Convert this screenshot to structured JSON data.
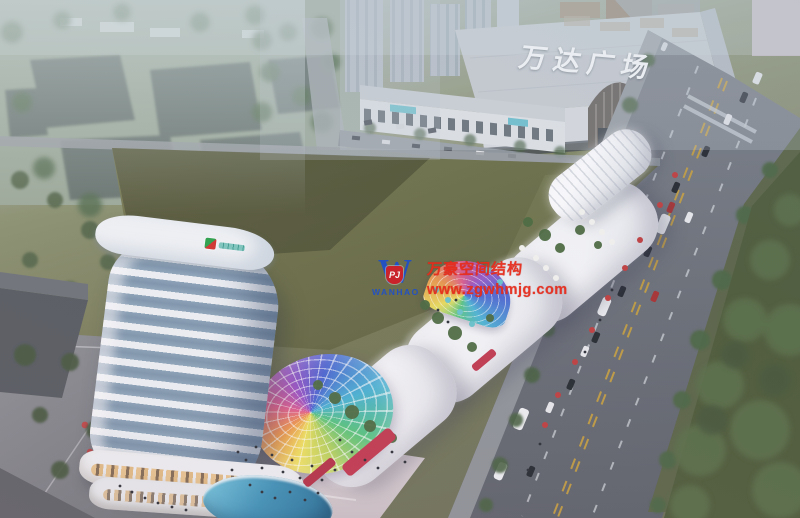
{
  "signs": {
    "mall_roof": "万达广场"
  },
  "watermark": {
    "logo_letter": "W",
    "logo_badge": "PJ",
    "logo_brand": "WANHAO",
    "title": "万豪空间结构",
    "website": "www.zgwhmjg.com"
  },
  "palette": {
    "watermark_red": "#e82c1c",
    "brand_blue": "#2050c8",
    "badge_red": "#cf1f2a",
    "mall_sign_white": "#f2f5f6",
    "field_olive": "#6e7249",
    "road_gray": "#6e737a",
    "lawn_green": "#4f5c3a",
    "tower_glass_blue": "#87a0b5",
    "retail_white": "#f1f2f4",
    "terrace_accent_red": "#c23a50",
    "dome_colors": [
      "#efe25e",
      "#ef9a4e",
      "#e2608e",
      "#9a55c5",
      "#4a66d2",
      "#49b4d4",
      "#57c57d"
    ]
  }
}
